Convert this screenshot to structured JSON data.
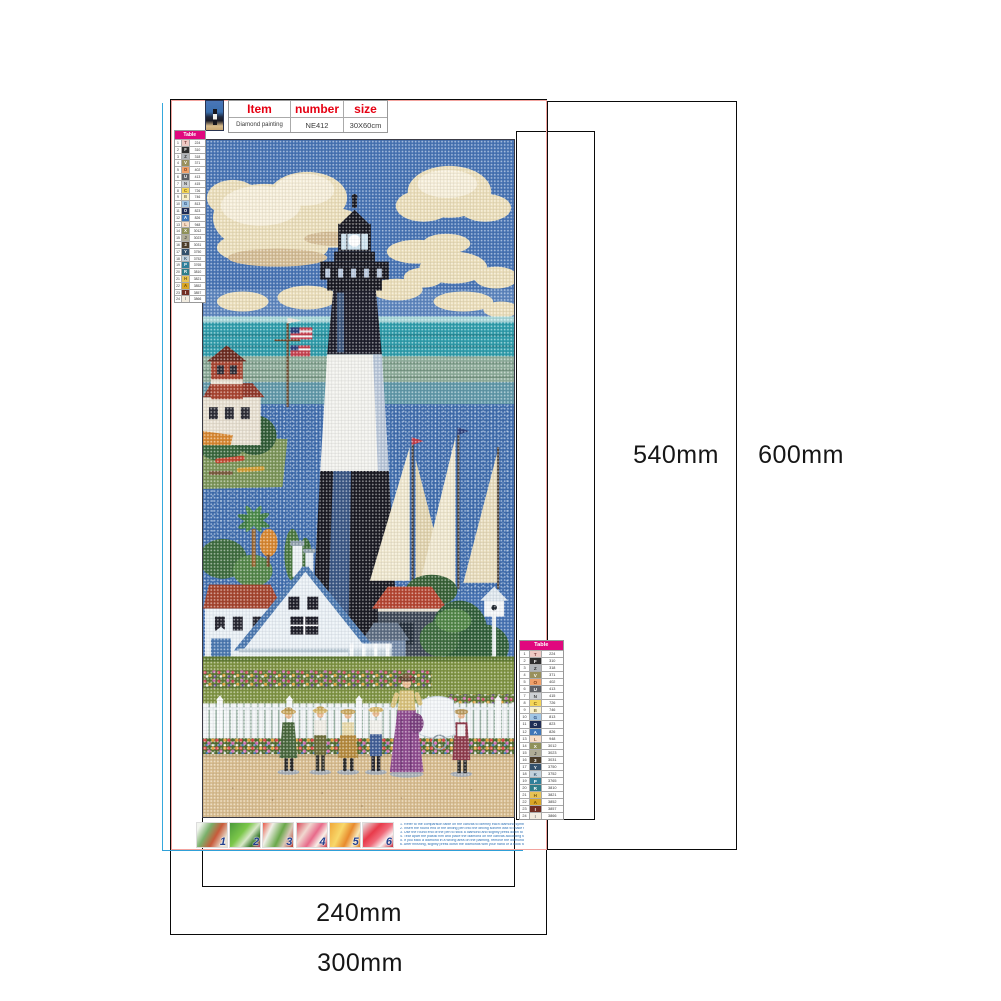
{
  "dimensions": {
    "inner_height": "540mm",
    "outer_height": "600mm",
    "inner_width": "240mm",
    "outer_width": "300mm"
  },
  "header": {
    "item_label": "Item",
    "number_label": "number",
    "size_label": "size",
    "item_value": "Diamond painting",
    "number_value": "NE412",
    "size_value": "30X60cm"
  },
  "color_table": {
    "title": "Table",
    "rows": [
      {
        "n": "1",
        "sym": "T",
        "code": "224",
        "bg": "#eec9c4",
        "fg": "#7a3a3a"
      },
      {
        "n": "2",
        "sym": "F",
        "code": "310",
        "bg": "#2e2e2e",
        "fg": "#ffffff"
      },
      {
        "n": "3",
        "sym": "Z",
        "code": "318",
        "bg": "#b0b4b8",
        "fg": "#333333"
      },
      {
        "n": "4",
        "sym": "V",
        "code": "371",
        "bg": "#99905c",
        "fg": "#ffffff"
      },
      {
        "n": "5",
        "sym": "O",
        "code": "402",
        "bg": "#efa06a",
        "fg": "#7a3a16"
      },
      {
        "n": "6",
        "sym": "U",
        "code": "413",
        "bg": "#5e6065",
        "fg": "#ffffff"
      },
      {
        "n": "7",
        "sym": "N",
        "code": "415",
        "bg": "#cdd0d4",
        "fg": "#444444"
      },
      {
        "n": "8",
        "sym": "C",
        "code": "726",
        "bg": "#f4d558",
        "fg": "#7a5a10"
      },
      {
        "n": "9",
        "sym": "B",
        "code": "746",
        "bg": "#f8f0cd",
        "fg": "#8a7a40"
      },
      {
        "n": "10",
        "sym": "G",
        "code": "813",
        "bg": "#a2c6e4",
        "fg": "#2a4a7a"
      },
      {
        "n": "11",
        "sym": "O",
        "code": "823",
        "bg": "#1f2c55",
        "fg": "#ffffff"
      },
      {
        "n": "12",
        "sym": "A",
        "code": "826",
        "bg": "#3f76b8",
        "fg": "#ffffff"
      },
      {
        "n": "13",
        "sym": "L",
        "code": "948",
        "bg": "#f6ddc8",
        "fg": "#9a6a4a"
      },
      {
        "n": "14",
        "sym": "X",
        "code": "3012",
        "bg": "#8f9159",
        "fg": "#ffffff"
      },
      {
        "n": "15",
        "sym": "J",
        "code": "3023",
        "bg": "#b0ac96",
        "fg": "#444444"
      },
      {
        "n": "16",
        "sym": "3",
        "code": "3031",
        "bg": "#4d3e2a",
        "fg": "#ffffff"
      },
      {
        "n": "17",
        "sym": "Y",
        "code": "3750",
        "bg": "#33506b",
        "fg": "#ffffff"
      },
      {
        "n": "18",
        "sym": "K",
        "code": "3752",
        "bg": "#c3d2dd",
        "fg": "#3a5a74"
      },
      {
        "n": "19",
        "sym": "P",
        "code": "3765",
        "bg": "#2f7f9a",
        "fg": "#ffffff"
      },
      {
        "n": "20",
        "sym": "R",
        "code": "3810",
        "bg": "#2e7e8a",
        "fg": "#ffffff"
      },
      {
        "n": "21",
        "sym": "H",
        "code": "3821",
        "bg": "#e7c355",
        "fg": "#7a5a10"
      },
      {
        "n": "22",
        "sym": "A",
        "code": "3852",
        "bg": "#d9a627",
        "fg": "#6a4a08"
      },
      {
        "n": "23",
        "sym": "I",
        "code": "3857",
        "bg": "#722e23",
        "fg": "#ffffff"
      },
      {
        "n": "24",
        "sym": "I",
        "code": "3866",
        "bg": "#f2ece0",
        "fg": "#888888"
      }
    ]
  },
  "steps": [
    {
      "n": "1",
      "bg": "linear-gradient(120deg,#f2f5ef 10%,#7ab06a 35%,#c85a3a 60%,#e8e0d0 85%)"
    },
    {
      "n": "2",
      "bg": "linear-gradient(130deg,#4a9a3a 0%,#7cc74a 40%,#d8e8c8 60%,#3a7a2e 80%,#c84a6a 100%)"
    },
    {
      "n": "3",
      "bg": "linear-gradient(115deg,#e85a4a 0%,#f0f0e8 25%,#6aa84a 55%,#d8c8b8 75%,#b83a2e 100%)"
    },
    {
      "n": "4",
      "bg": "linear-gradient(125deg,#d84a5a 0%,#f0d8d0 30%,#e86a8a 55%,#f8f0e8 75%,#c83a4a 100%)"
    },
    {
      "n": "5",
      "bg": "linear-gradient(115deg,#f0a83a 0%,#f8d86a 35%,#e88a2e 60%,#f8e8b8 80%,#d87a1e 100%)"
    },
    {
      "n": "6",
      "bg": "linear-gradient(135deg,#e8e8e8 0%,#e83a4a 35%,#f06a7a 55%,#f8f0f0 75%,#c82a3a 100%)"
    }
  ],
  "instructions": [
    "1. Refer to the comparison table on the canvas to identify each diamond symbol and the corresponding printed number on the canvas.",
    "2. Insert the round end of the drilling pen into the drilling solvent wax to make the pen nib easy to absorb the diamond.",
    "3. Use the round end of the pen to stick a diamond and slightly press down to remove any outer cement.",
    "4. Tear apart the plastic film and place the diamond on the canvas according to the corresponding symbol or number.",
    "5. If you stick a diamond in a wrong area on the painting, remove the diamond with tweezers and stick it again.",
    "6. After finishing, slightly press down the diamonds with your hand or a book to ensure that the diamonds are firmly attached."
  ],
  "accents": {
    "magenta": "#e0077e",
    "pink_border": "#f2a39e",
    "cyan_line": "#35a8dc",
    "red_text": "#e60012",
    "blue_text": "#2a6fb5",
    "dim_line": "#0a0a0a"
  }
}
